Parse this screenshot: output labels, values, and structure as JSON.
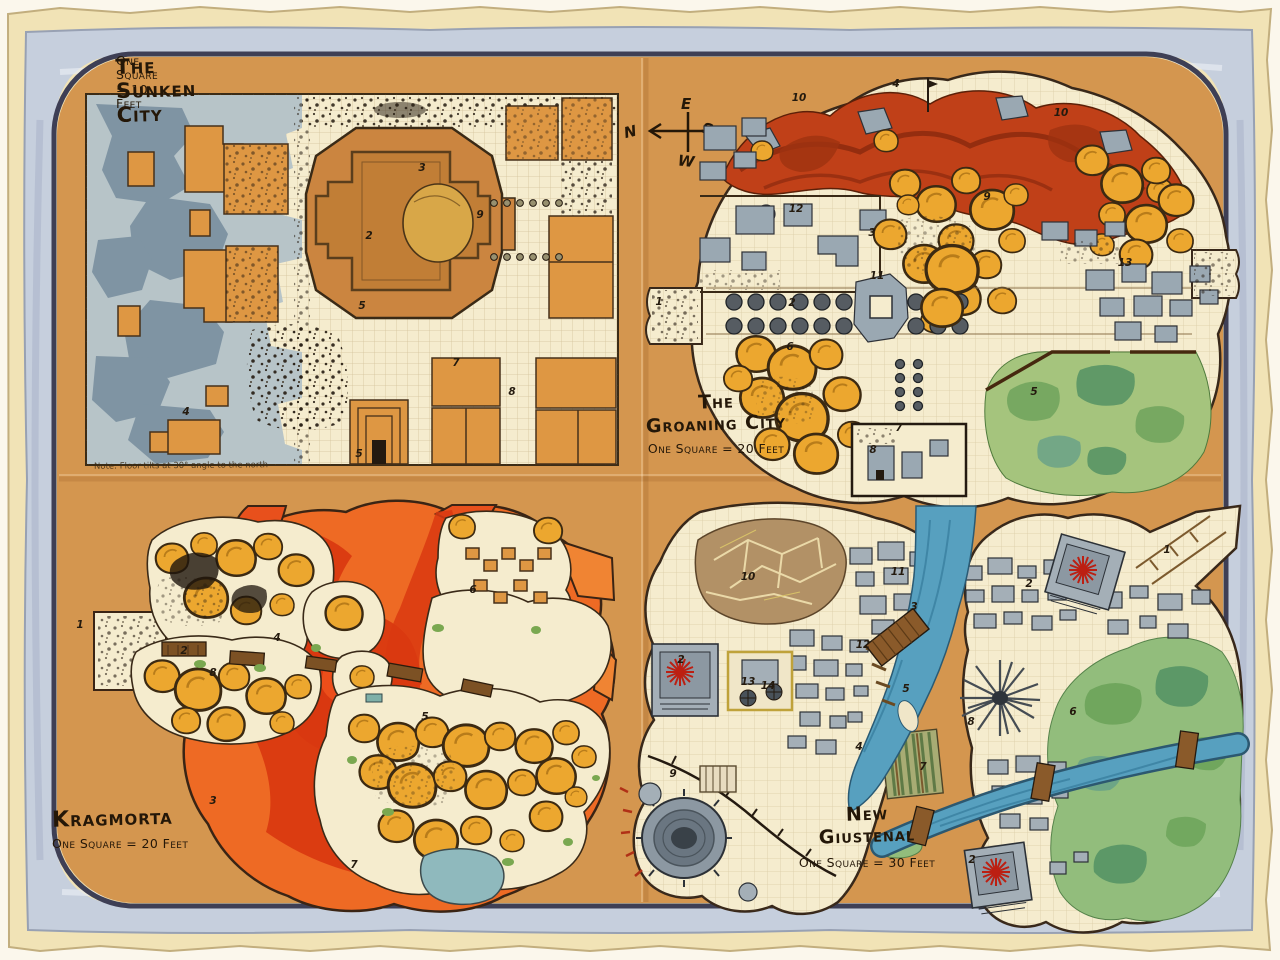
{
  "palette": {
    "paper_cream": "#f1e3b6",
    "border_band_blue": "#c6cfdd",
    "border_edge_dark": "#3e3f55",
    "parchment_orange": "#d4964f",
    "map_floor_cream": "#f5ecce",
    "ruin_slate": "#7f94a3",
    "ruin_slate_light": "#b7c4c8",
    "building_orange": "#de9743",
    "temple_tan": "#cb8540",
    "dome_yellow": "#eca72f",
    "lava_red": "#d93810",
    "lava_orange": "#ee6a24",
    "ridge_red": "#c04018",
    "building_gray": "#a4afb7",
    "river_blue": "#57a0bf",
    "park_green": "#92bd7c",
    "pond_teal": "#8fb9bd",
    "temple_star_red": "#bc1f12",
    "ink": "#241a0e"
  },
  "compass": {
    "north": "N",
    "east": "E",
    "south": "S",
    "west": "W"
  },
  "maps": {
    "sunken_city": {
      "title": "The Sunken City",
      "scale_label": "One Square = 10 Feet",
      "note": "Note: Floor tilts at 30° angle to the north",
      "markers": [
        {
          "n": "3",
          "x": 422,
          "y": 168
        },
        {
          "n": "2",
          "x": 369,
          "y": 236
        },
        {
          "n": "9",
          "x": 480,
          "y": 215
        },
        {
          "n": "5",
          "x": 362,
          "y": 306
        },
        {
          "n": "4",
          "x": 186,
          "y": 412
        },
        {
          "n": "7",
          "x": 456,
          "y": 363
        },
        {
          "n": "8",
          "x": 512,
          "y": 392
        },
        {
          "n": "5",
          "x": 359,
          "y": 454
        }
      ]
    },
    "groaning_city": {
      "title": "The Groaning City",
      "title_lines": [
        "The",
        "Groaning City"
      ],
      "scale_label": "One Square = 20 Feet",
      "markers": [
        {
          "n": "10",
          "x": 799,
          "y": 98
        },
        {
          "n": "4",
          "x": 896,
          "y": 84
        },
        {
          "n": "10",
          "x": 1061,
          "y": 113
        },
        {
          "n": "9",
          "x": 987,
          "y": 197
        },
        {
          "n": "12",
          "x": 796,
          "y": 209
        },
        {
          "n": "3",
          "x": 872,
          "y": 233
        },
        {
          "n": "13",
          "x": 1125,
          "y": 263
        },
        {
          "n": "11",
          "x": 877,
          "y": 276
        },
        {
          "n": "1",
          "x": 659,
          "y": 302
        },
        {
          "n": "2",
          "x": 792,
          "y": 303
        },
        {
          "n": "6",
          "x": 790,
          "y": 347
        },
        {
          "n": "5",
          "x": 1034,
          "y": 392
        },
        {
          "n": "7",
          "x": 899,
          "y": 428
        },
        {
          "n": "8",
          "x": 873,
          "y": 450
        }
      ]
    },
    "kragmorta": {
      "title": "Kragmorta",
      "scale_label": "One Square = 20 Feet",
      "markers": [
        {
          "n": "6",
          "x": 473,
          "y": 590
        },
        {
          "n": "1",
          "x": 80,
          "y": 625
        },
        {
          "n": "4",
          "x": 277,
          "y": 638
        },
        {
          "n": "2",
          "x": 184,
          "y": 651
        },
        {
          "n": "8",
          "x": 213,
          "y": 673
        },
        {
          "n": "5",
          "x": 425,
          "y": 717
        },
        {
          "n": "3",
          "x": 213,
          "y": 801
        },
        {
          "n": "7",
          "x": 354,
          "y": 865
        }
      ]
    },
    "new_giustenal": {
      "title": "New Giustenal",
      "title_lines": [
        "New",
        "Giustenal"
      ],
      "scale_label": "One Square = 30 Feet",
      "markers": [
        {
          "n": "1",
          "x": 1167,
          "y": 550
        },
        {
          "n": "11",
          "x": 898,
          "y": 572
        },
        {
          "n": "10",
          "x": 748,
          "y": 577
        },
        {
          "n": "2",
          "x": 1029,
          "y": 584
        },
        {
          "n": "3",
          "x": 914,
          "y": 607
        },
        {
          "n": "12",
          "x": 863,
          "y": 645
        },
        {
          "n": "2",
          "x": 681,
          "y": 660
        },
        {
          "n": "13",
          "x": 748,
          "y": 682
        },
        {
          "n": "14",
          "x": 768,
          "y": 686
        },
        {
          "n": "5",
          "x": 906,
          "y": 689
        },
        {
          "n": "8",
          "x": 971,
          "y": 722
        },
        {
          "n": "6",
          "x": 1073,
          "y": 712
        },
        {
          "n": "4",
          "x": 859,
          "y": 747
        },
        {
          "n": "7",
          "x": 923,
          "y": 767
        },
        {
          "n": "9",
          "x": 673,
          "y": 774
        },
        {
          "n": "2",
          "x": 972,
          "y": 860
        }
      ]
    }
  }
}
